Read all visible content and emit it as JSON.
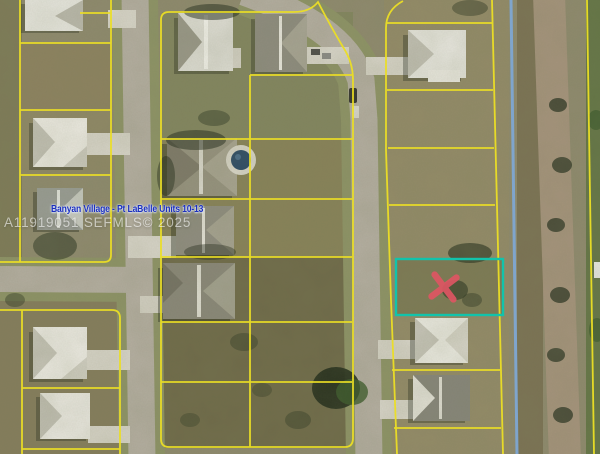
{
  "watermark": {
    "title": "Banyan Village - Pt LaBelle Units 10-13",
    "id_line": "A11919051  SEFMLS© 2025",
    "mls_number": "A11919051",
    "source": "SEFMLS",
    "year": "2025"
  },
  "map": {
    "type": "aerial-parcel-map",
    "subject_marker_glyph": "✕",
    "colors": {
      "parcel_lines": "#ecdf25",
      "subject_outline": "#12c3ab",
      "subject_marker": "#de5663",
      "water_line": "#7da9d8"
    }
  }
}
